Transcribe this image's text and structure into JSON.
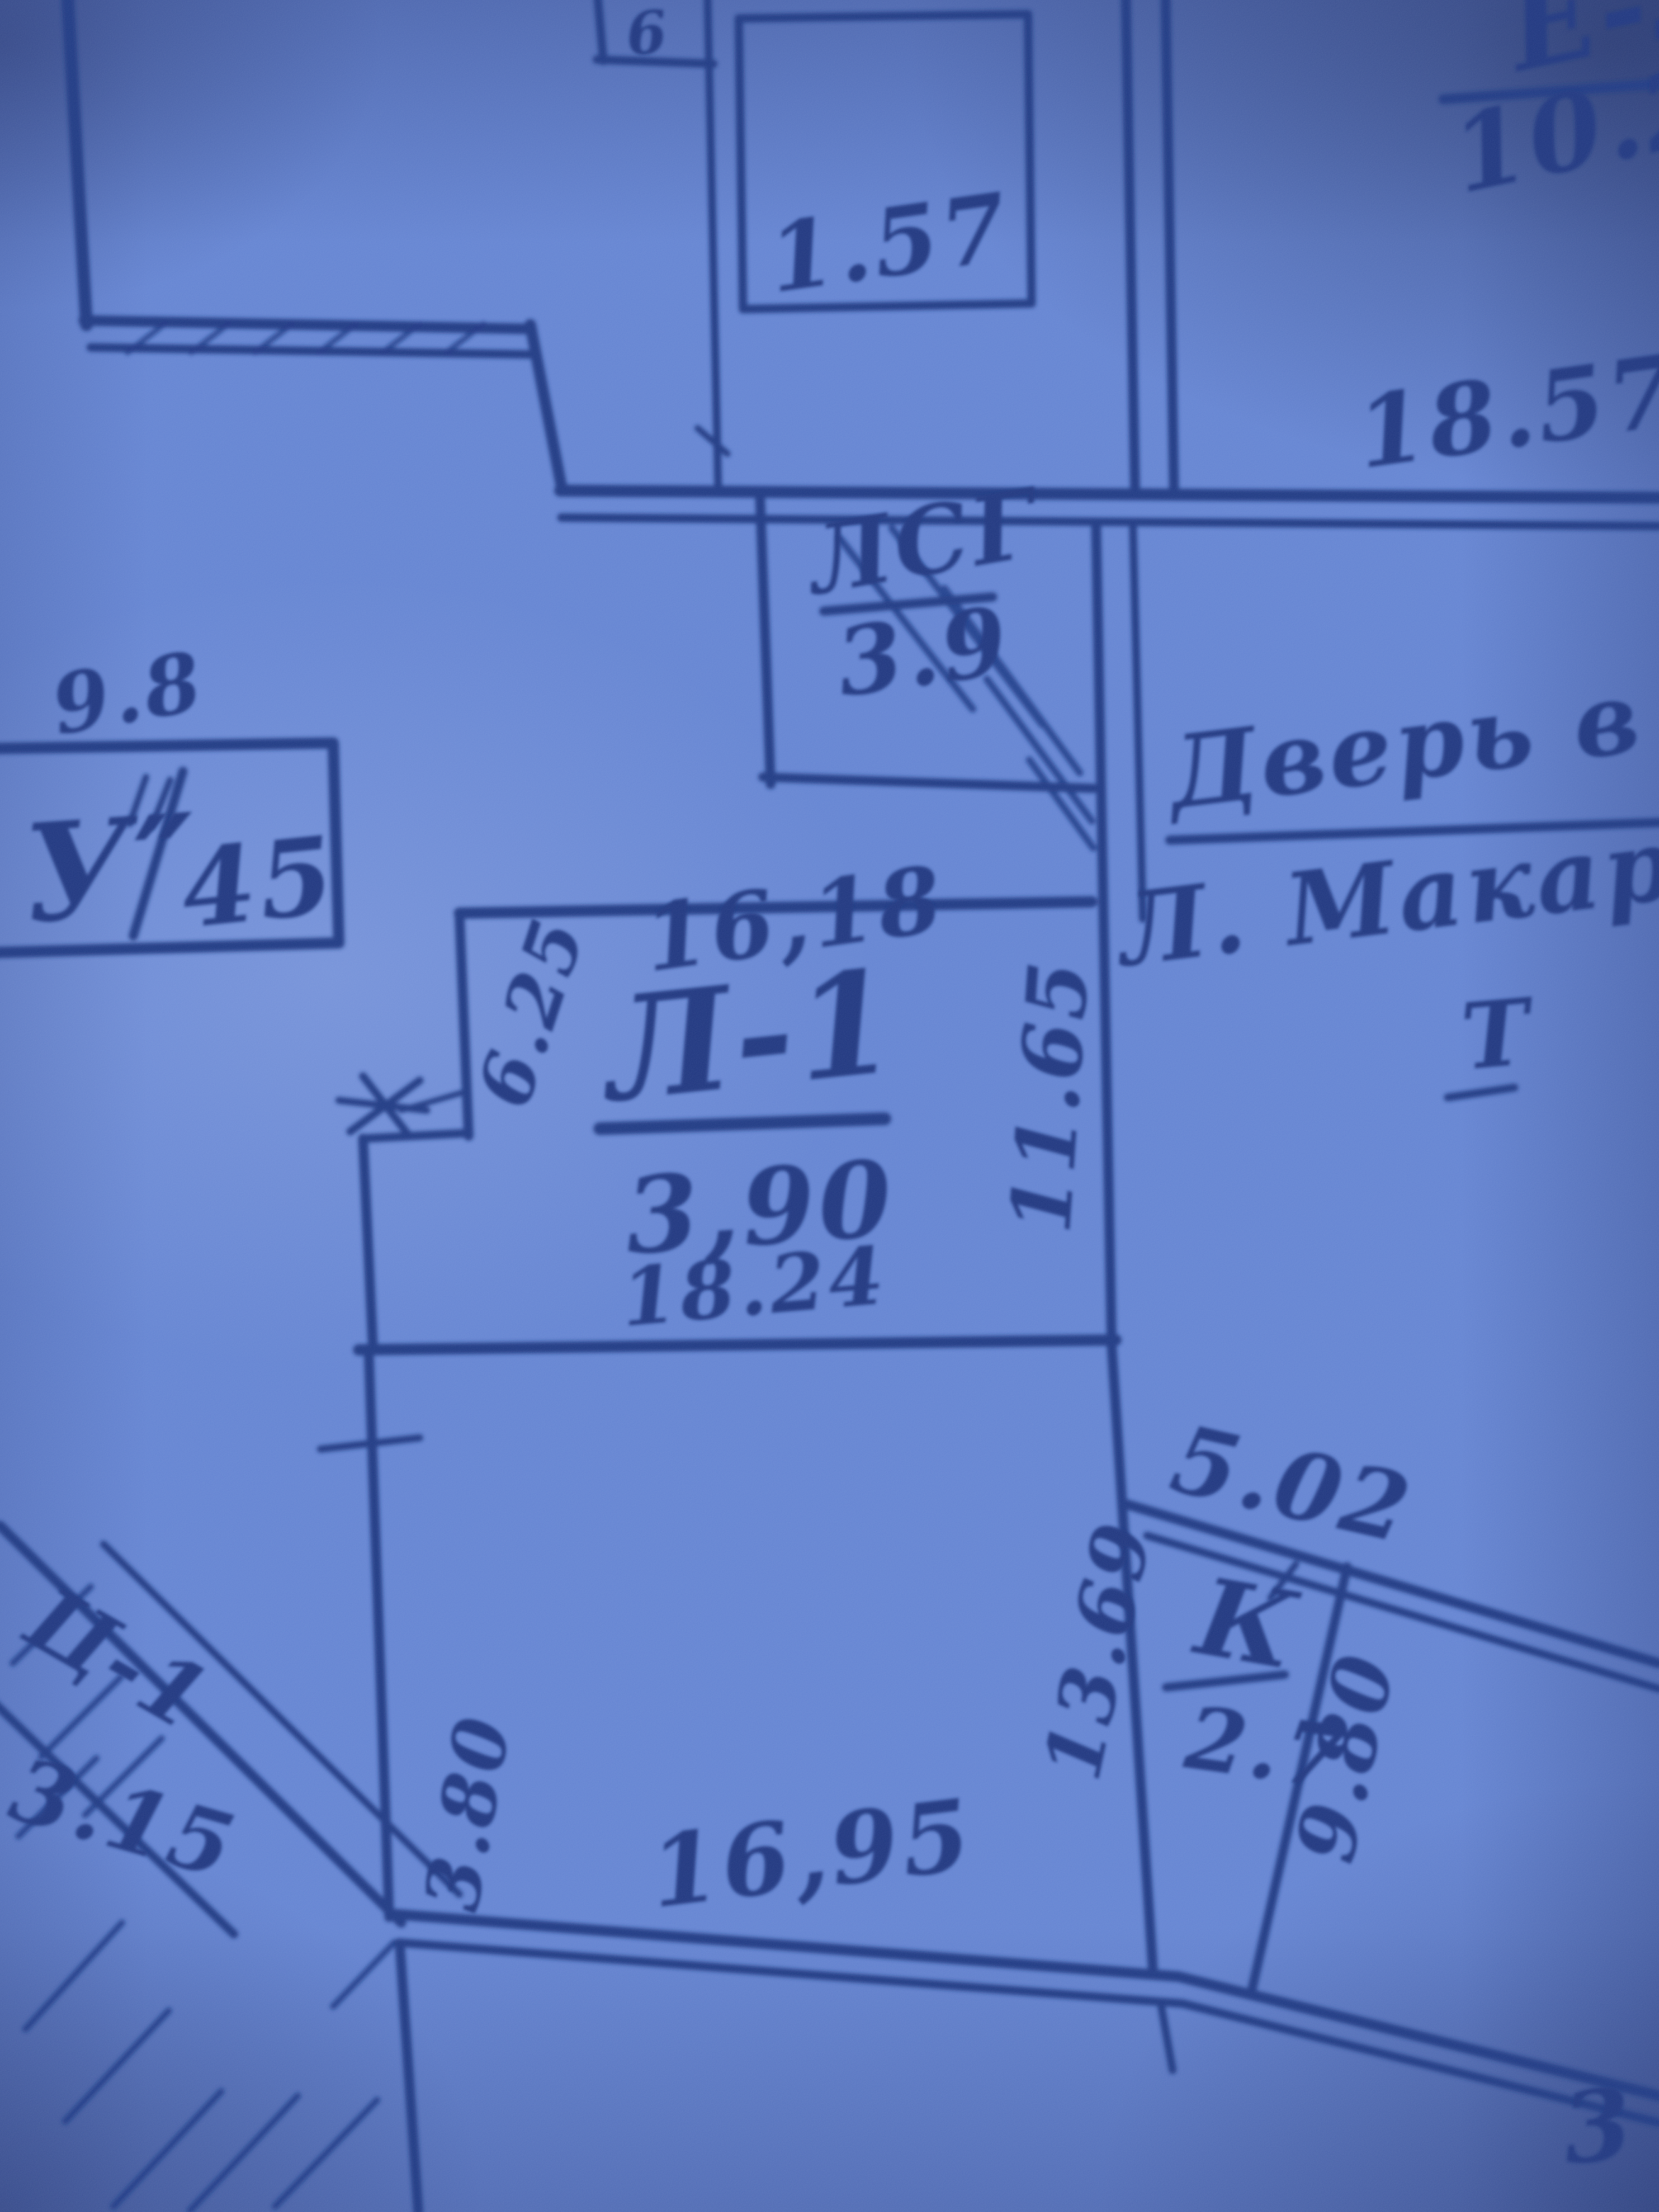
{
  "colors": {
    "paper": "#5e7fd0",
    "ink": "#13307e"
  },
  "plan": {
    "rooms": {
      "e3": {
        "label": "Е-3",
        "area": "10.21"
      },
      "top_room": {
        "area": "1.57"
      },
      "top_box": {
        "label": "6"
      },
      "shaft": {
        "label": "ЛСГ",
        "area": "3.9"
      },
      "u_room": {
        "label": "У″",
        "area": "45"
      },
      "l1": {
        "label": "Л-1",
        "area": "3,90"
      },
      "k": {
        "label": "К",
        "area": "2.7"
      },
      "c1": {
        "label": "Ц-1",
        "area": "3.15"
      }
    },
    "dimensions": {
      "d18_57": "18.57",
      "d9_8": "9.8",
      "d16_18": "16,18",
      "d18_24": "18.24",
      "d11_65": "11.65",
      "d6_25": "6.25",
      "d5_02": "5.02",
      "d13_69": "13.69",
      "d9_80": "9.80",
      "d16_95": "16,95",
      "d3_80": "3.80",
      "d3": "3"
    },
    "note": {
      "line1": "Дверь в о",
      "line2": "Л. Макарова",
      "t_mark": "Т"
    }
  }
}
